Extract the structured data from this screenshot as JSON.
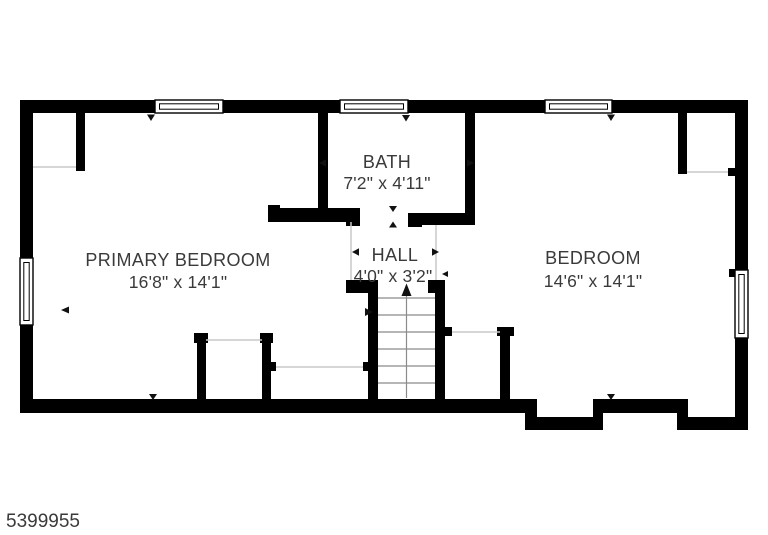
{
  "floor_plan": {
    "watermark_id": "5399955",
    "rooms": {
      "primary_bedroom": {
        "name": "PRIMARY BEDROOM",
        "dimensions": "16'8\" x 14'1\""
      },
      "bath": {
        "name": "BATH",
        "dimensions": "7'2\" x 4'11\""
      },
      "hall": {
        "name": "HALL",
        "dimensions": "4'0\" x 3'2\""
      },
      "bedroom": {
        "name": "BEDROOM",
        "dimensions": "14'6\" x 14'1\""
      }
    },
    "features": {
      "staircase": "stairs up from hall",
      "windows": 5,
      "closets": 5
    },
    "colors": {
      "wall": "#000000",
      "background": "#ffffff",
      "label_text": "#3a3a3a",
      "opening_line": "#c9c9c9",
      "stair_line": "#8a8a8a"
    }
  }
}
